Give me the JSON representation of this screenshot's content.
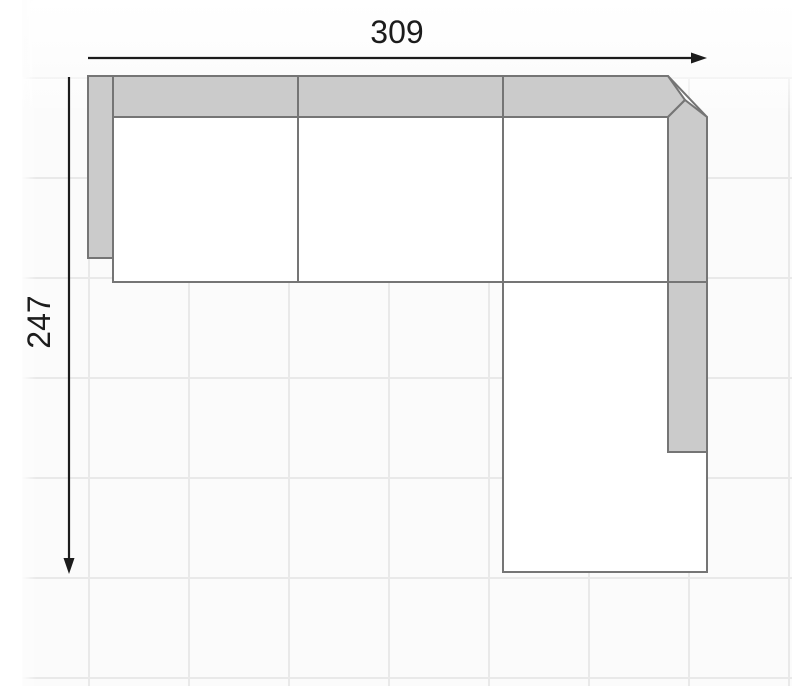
{
  "diagram": {
    "type": "furniture-dimension-plan",
    "subject": "sectional sofa with right-hand chaise, top view",
    "dimensions": {
      "width": {
        "label": "309",
        "arrow_direction": "right"
      },
      "height": {
        "label": "247",
        "arrow_direction": "down"
      }
    },
    "sections": [
      "left-armrest",
      "back-cushion-band",
      "seat-1",
      "seat-2",
      "seat-3",
      "corner-chamfer",
      "right-armrest",
      "chaise"
    ],
    "colors": {
      "cushion_fill": "#cbcbcb",
      "seat_fill": "#ffffff",
      "outline": "#757575",
      "dimension": "#1c1c1c",
      "grid_line": "#e9e9e9",
      "canvas_bg": "#fbfbfb"
    }
  }
}
